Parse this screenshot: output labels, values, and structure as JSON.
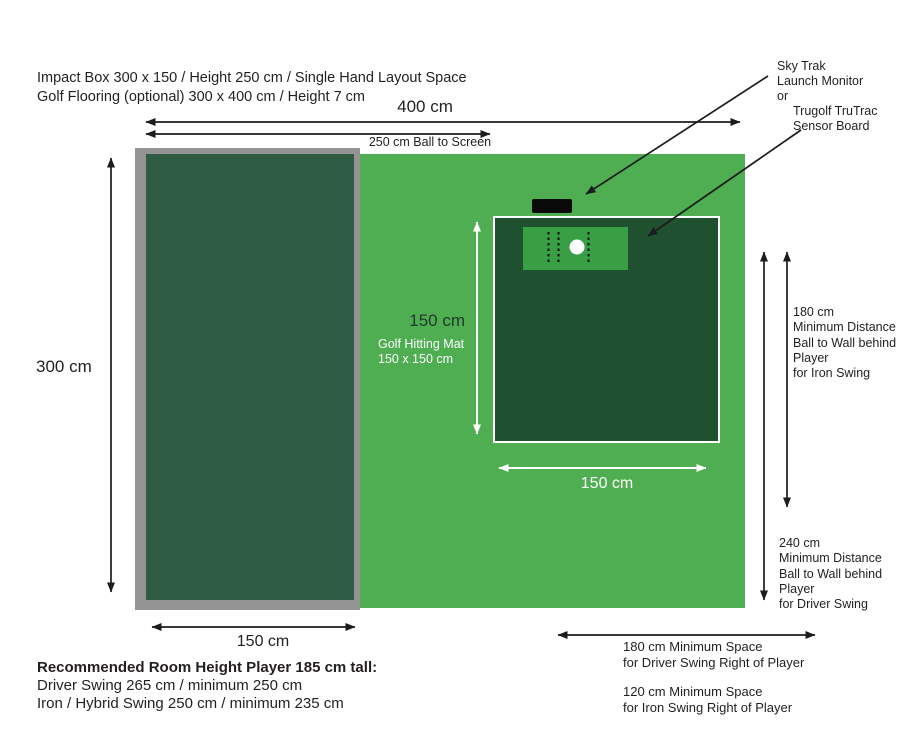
{
  "colors": {
    "flooring_green": "#4fae52",
    "impact_box_green": "#2f5d43",
    "impact_box_frame_gray": "#949494",
    "hitting_mat_green": "#1f5130",
    "sensor_board_green": "#389f45",
    "monitor_black": "#0a0a0a",
    "arrow_black": "#1c1c1c",
    "arrow_white": "#ffffff",
    "text_dark": "#231f20"
  },
  "header": {
    "line1": "Impact Box 300 x 150 / Height 250 cm / Single Hand Layout Space",
    "line2": "Golf Flooring (optional) 300 x 400 cm /  Height 7 cm"
  },
  "dimensions": {
    "total_width": "400 cm",
    "ball_to_screen": "250 cm Ball to Screen",
    "room_depth": "300 cm",
    "impact_box_width": "150 cm",
    "mat_height": "150 cm",
    "mat_name": "Golf Hitting Mat",
    "mat_size": "150 x 150 cm",
    "mat_width": "150 cm"
  },
  "sensor_callout": {
    "line1": "Sky Trak",
    "line2": "Launch Monitor",
    "line3": "or",
    "line4": "Trugolf TruTrac",
    "line5": "Sensor Board"
  },
  "iron_clearance": {
    "value": "180 cm",
    "line1": "Minimum Distance",
    "line2": "Ball to Wall behind",
    "line3": "Player",
    "line4": "for Iron Swing"
  },
  "driver_clearance": {
    "value": "240 cm",
    "line1": "Minimum Distance",
    "line2": "Ball to Wall behind",
    "line3": "Player",
    "line4": "for Driver Swing"
  },
  "driver_space": {
    "line1": "180 cm Minimum Space",
    "line2": "for Driver Swing Right of Player"
  },
  "iron_space": {
    "line1": "120 cm Minimum Space",
    "line2": "for Iron Swing Right of Player"
  },
  "footer": {
    "title": "Recommended Room Height Player 185 cm tall:",
    "line1": "Driver Swing 265 cm / minimum 250 cm",
    "line2": "Iron / Hybrid Swing 250 cm / minimum 235 cm"
  }
}
